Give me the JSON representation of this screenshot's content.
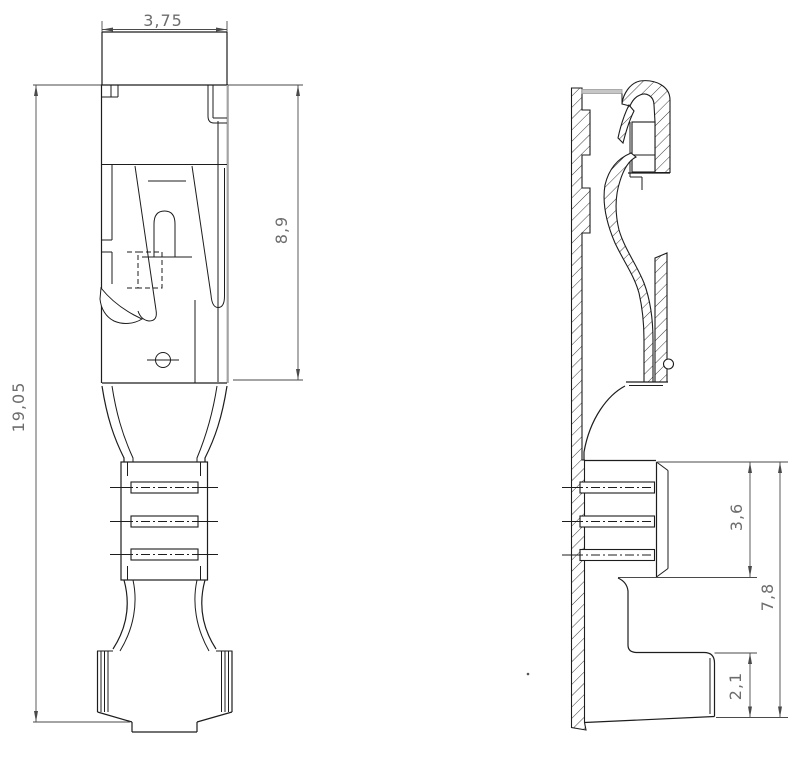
{
  "dimensions": {
    "top_width": "3,75",
    "overall_length": "19,05",
    "receptacle_height": "8,9",
    "wire_crimp_height": "3,6",
    "rear_section_height": "7,8",
    "tab_height": "2,1"
  },
  "colors": {
    "line": "#1d1d1d",
    "gray-edge": "#a3a3a3",
    "dim-line": "#4a4a4a",
    "dim-text": "#6d6d6d",
    "hatch": "#3c3c3c",
    "background": "#ffffff"
  }
}
